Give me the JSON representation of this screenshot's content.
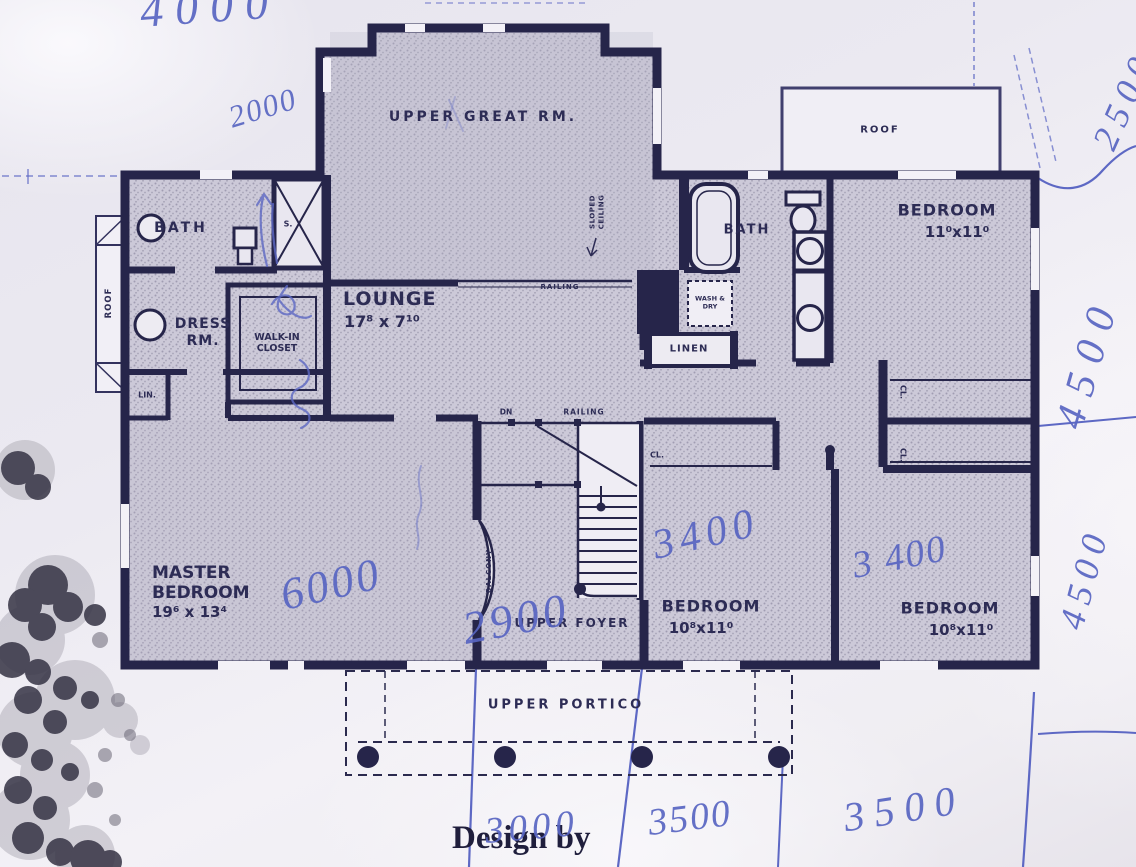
{
  "labels": {
    "upper_great_rm": "UPPER GREAT RM.",
    "sloped_ceiling": "SLOPED CEILING",
    "bath_left": "BATH",
    "shower": "S.",
    "dress_rm": "DRESS RM.",
    "walk_in_closet": "WALK-IN CLOSET",
    "lin": "LIN.",
    "lounge": "LOUNGE",
    "lounge_dims": "17⁸ x 7¹⁰",
    "railing_lounge": "RAILING",
    "dn": "DN",
    "railing_stairs": "RAILING",
    "master_name": "MASTER BEDROOM",
    "master_dims": "19⁶ x 13⁴",
    "bath_right": "BATH",
    "wash_dry": "WASH & DRY",
    "linen": "LINEN",
    "bedroom_tr_name": "BEDROOM",
    "bedroom_tr_dims": "11⁰x11⁰",
    "cl_hall": "CL.",
    "cl_right_1": "CL.",
    "cl_right_2": "CL.",
    "bedroom_bc_name": "BEDROOM",
    "bedroom_bc_dims": "10⁸x11⁰",
    "bedroom_br_name": "BEDROOM",
    "bedroom_br_dims": "10⁸x11⁰",
    "upper_foyer": "UPPER FOYER",
    "balcony": "BALCONY",
    "upper_portico": "UPPER PORTICO",
    "roof_upper_right": "ROOF",
    "roof_left_bay": "ROOF",
    "design_by": "Design by"
  },
  "handwritten": {
    "top": "4000",
    "left_upper": "2000",
    "master": "6000",
    "foyer": "2900",
    "bedroom_center": "3400",
    "bedroom_right": "3 400",
    "bottom_left": "3000",
    "bottom_center": "3500",
    "bottom_right": "3500",
    "side_top_partial": "2500",
    "side_mid": "4500",
    "side_lower": "4500"
  },
  "colors": {
    "ink_navy": "#26254a",
    "pen_blue": "#5d68c4",
    "paper": "#efedf4",
    "room_fill": "#ccc9d8"
  }
}
